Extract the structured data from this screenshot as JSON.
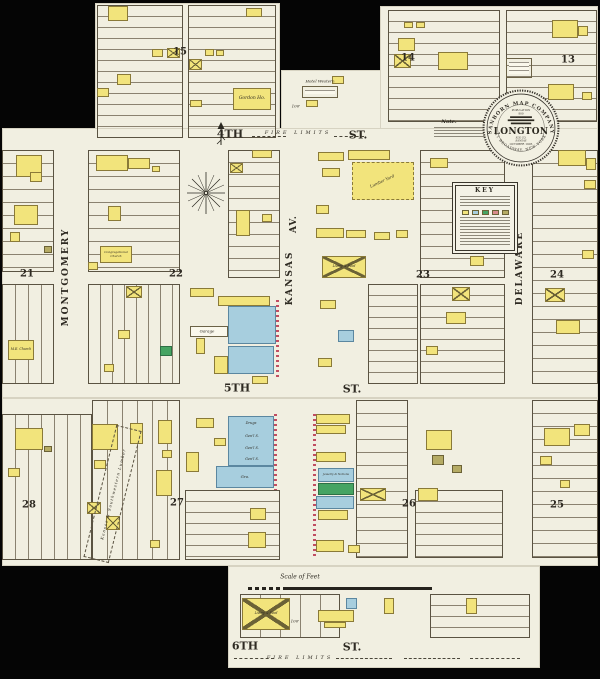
{
  "palette": {
    "paper": "#f1efe1",
    "background": "#050505",
    "ink": "#332f26",
    "lot_line": "#8a8270",
    "frame_yellow": "#f2e47c",
    "stone_blue": "#a7cede",
    "special_green": "#46a463",
    "adobe_olive": "#b5ab64",
    "brick_pink": "#d98b8b",
    "tick_red": "#c14e62"
  },
  "seal": {
    "arc_top": "SANBORN MAP COMPANY",
    "pop_label": "POPULATION",
    "pop_value": "800",
    "town": "LONGTON",
    "county1": "ELK CO.",
    "county2": "KANSAS",
    "date": "OCTOBER 1905",
    "arc_bottom": "11 BROADWAY. NEW YORK."
  },
  "key": {
    "title": "KEY"
  },
  "lumber": {
    "west_label": "Kansas & Southwestern Lumber"
  },
  "labels": [
    {
      "n": "street-4th",
      "t": "4TH",
      "x": 230,
      "y": 134,
      "s": 11,
      "b": 1
    },
    {
      "n": "street-4th-st",
      "t": "ST.",
      "x": 358,
      "y": 135,
      "s": 11,
      "b": 1
    },
    {
      "n": "fire-limits-top",
      "t": "FIRE LIMITS",
      "x": 298,
      "y": 133,
      "s": 5,
      "i": 1,
      "sp": 3
    },
    {
      "n": "street-5th",
      "t": "5TH",
      "x": 237,
      "y": 388,
      "s": 11,
      "b": 1
    },
    {
      "n": "street-5th-st",
      "t": "ST.",
      "x": 352,
      "y": 389,
      "s": 11,
      "b": 1
    },
    {
      "n": "street-6th",
      "t": "6TH",
      "x": 245,
      "y": 646,
      "s": 11,
      "b": 1
    },
    {
      "n": "street-6th-st",
      "t": "ST.",
      "x": 352,
      "y": 647,
      "s": 11,
      "b": 1
    },
    {
      "n": "fire-limits-bottom",
      "t": "FIRE LIMITS",
      "x": 300,
      "y": 658,
      "s": 5,
      "i": 1,
      "sp": 3
    },
    {
      "n": "street-kansas",
      "t": "KANSAS",
      "x": 290,
      "y": 278,
      "s": 9,
      "b": 1,
      "r": -90,
      "sp": 2
    },
    {
      "n": "street-kansas-av",
      "t": "AV.",
      "x": 294,
      "y": 224,
      "s": 9,
      "b": 1,
      "r": -90,
      "sp": 1
    },
    {
      "n": "street-montgomery",
      "t": "MONTGOMERY",
      "x": 66,
      "y": 277,
      "s": 9,
      "b": 1,
      "r": -90,
      "sp": 2
    },
    {
      "n": "street-delaware",
      "t": "DELAWARE",
      "x": 520,
      "y": 268,
      "s": 9,
      "b": 1,
      "r": -90,
      "sp": 2
    },
    {
      "n": "block-number-15",
      "t": "15",
      "x": 180,
      "y": 52,
      "s": 10,
      "b": 1
    },
    {
      "n": "block-number-14",
      "t": "14",
      "x": 408,
      "y": 58,
      "s": 10,
      "b": 1
    },
    {
      "n": "block-number-13",
      "t": "13",
      "x": 568,
      "y": 60,
      "s": 10,
      "b": 1
    },
    {
      "n": "block-number-21",
      "t": "21",
      "x": 27,
      "y": 274,
      "s": 10,
      "b": 1
    },
    {
      "n": "block-number-22",
      "t": "22",
      "x": 176,
      "y": 274,
      "s": 10,
      "b": 1
    },
    {
      "n": "block-number-23",
      "t": "23",
      "x": 423,
      "y": 275,
      "s": 10,
      "b": 1
    },
    {
      "n": "block-number-24",
      "t": "24",
      "x": 557,
      "y": 275,
      "s": 10,
      "b": 1
    },
    {
      "n": "block-number-28",
      "t": "28",
      "x": 29,
      "y": 505,
      "s": 10,
      "b": 1
    },
    {
      "n": "block-number-27",
      "t": "27",
      "x": 177,
      "y": 503,
      "s": 10,
      "b": 1
    },
    {
      "n": "block-number-26",
      "t": "26",
      "x": 409,
      "y": 504,
      "s": 10,
      "b": 1
    },
    {
      "n": "block-number-25",
      "t": "25",
      "x": 557,
      "y": 505,
      "s": 10,
      "b": 1
    },
    {
      "n": "scale-label",
      "t": "Scale of Feet",
      "x": 300,
      "y": 577,
      "s": 6,
      "i": 1
    },
    {
      "n": "note-title",
      "t": "Note.",
      "x": 449,
      "y": 122,
      "s": 5,
      "b": 1,
      "i": 1
    },
    {
      "n": "hotel-western-label",
      "t": "Hotel Western",
      "x": 320,
      "y": 81,
      "s": 4,
      "i": 1
    },
    {
      "n": "garage-label",
      "t": "Garage",
      "x": 207,
      "y": 331,
      "s": 4,
      "i": 1
    },
    {
      "n": "dimension-100-top",
      "t": "100'",
      "x": 296,
      "y": 106,
      "s": 4,
      "i": 1
    },
    {
      "n": "dimension-100-bottom",
      "t": "100'",
      "x": 295,
      "y": 621,
      "s": 4,
      "i": 1
    },
    {
      "n": "lumber-yard-east-label",
      "t": "Lumber Yard",
      "x": 382,
      "y": 181,
      "s": 4,
      "i": 1,
      "r": -25
    },
    {
      "n": "store-drugs-label",
      "t": "Drugs",
      "x": 251,
      "y": 423,
      "s": 3.5,
      "i": 1
    },
    {
      "n": "store-general-1-label",
      "t": "Gen'l S.",
      "x": 252,
      "y": 436,
      "s": 3.5,
      "i": 1
    },
    {
      "n": "store-general-2-label",
      "t": "Gen'l S.",
      "x": 252,
      "y": 448,
      "s": 3.5,
      "i": 1
    },
    {
      "n": "store-general-3-label",
      "t": "Gen'l S.",
      "x": 252,
      "y": 459,
      "s": 3.5,
      "i": 1
    }
  ],
  "lot_areas": [
    {
      "x": 97,
      "y": 5,
      "w": 86,
      "h": 133,
      "d": "h",
      "g": 11
    },
    {
      "x": 188,
      "y": 5,
      "w": 88,
      "h": 133,
      "d": "h",
      "g": 11
    },
    {
      "x": 388,
      "y": 10,
      "w": 112,
      "h": 112,
      "d": "h",
      "g": 11
    },
    {
      "x": 506,
      "y": 10,
      "w": 91,
      "h": 112,
      "d": "h",
      "g": 11
    },
    {
      "x": 2,
      "y": 150,
      "w": 52,
      "h": 122,
      "d": "h",
      "g": 13
    },
    {
      "x": 2,
      "y": 284,
      "w": 52,
      "h": 100,
      "d": "v",
      "g": 13
    },
    {
      "x": 88,
      "y": 150,
      "w": 92,
      "h": 122,
      "d": "h",
      "g": 13
    },
    {
      "x": 88,
      "y": 284,
      "w": 92,
      "h": 100,
      "d": "v",
      "g": 12
    },
    {
      "x": 228,
      "y": 150,
      "w": 52,
      "h": 128,
      "d": "h",
      "g": 12
    },
    {
      "x": 420,
      "y": 150,
      "w": 85,
      "h": 128,
      "d": "h",
      "g": 12
    },
    {
      "x": 420,
      "y": 284,
      "w": 85,
      "h": 100,
      "d": "h",
      "g": 11
    },
    {
      "x": 368,
      "y": 284,
      "w": 50,
      "h": 100,
      "d": "h",
      "g": 11
    },
    {
      "x": 532,
      "y": 150,
      "w": 66,
      "h": 234,
      "d": "h",
      "g": 13
    },
    {
      "x": 2,
      "y": 414,
      "w": 90,
      "h": 146,
      "d": "v",
      "g": 13
    },
    {
      "x": 92,
      "y": 400,
      "w": 88,
      "h": 160,
      "d": "v",
      "g": 15
    },
    {
      "x": 185,
      "y": 490,
      "w": 95,
      "h": 70,
      "d": "h",
      "g": 11
    },
    {
      "x": 356,
      "y": 400,
      "w": 52,
      "h": 158,
      "d": "h",
      "g": 13
    },
    {
      "x": 415,
      "y": 490,
      "w": 88,
      "h": 68,
      "d": "h",
      "g": 11
    },
    {
      "x": 532,
      "y": 400,
      "w": 66,
      "h": 158,
      "d": "h",
      "g": 13
    },
    {
      "x": 430,
      "y": 594,
      "w": 100,
      "h": 44,
      "d": "h",
      "g": 11
    },
    {
      "x": 240,
      "y": 594,
      "w": 100,
      "h": 44,
      "d": "v",
      "g": 20
    }
  ],
  "buildings": [
    {
      "x": 108,
      "y": 6,
      "w": 20,
      "h": 15,
      "c": "y"
    },
    {
      "x": 246,
      "y": 8,
      "w": 16,
      "h": 9,
      "c": "y"
    },
    {
      "x": 152,
      "y": 49,
      "w": 11,
      "h": 8,
      "c": "y"
    },
    {
      "x": 167,
      "y": 48,
      "w": 13,
      "h": 10,
      "c": "y",
      "xm": 1
    },
    {
      "x": 205,
      "y": 49,
      "w": 9,
      "h": 7,
      "c": "y"
    },
    {
      "x": 216,
      "y": 50,
      "w": 8,
      "h": 6,
      "c": "y"
    },
    {
      "x": 189,
      "y": 59,
      "w": 13,
      "h": 11,
      "c": "y",
      "xm": 1
    },
    {
      "x": 117,
      "y": 74,
      "w": 14,
      "h": 11,
      "c": "y"
    },
    {
      "x": 97,
      "y": 88,
      "w": 12,
      "h": 9,
      "c": "y"
    },
    {
      "x": 190,
      "y": 100,
      "w": 12,
      "h": 7,
      "c": "y"
    },
    {
      "x": 233,
      "y": 88,
      "w": 38,
      "h": 22,
      "c": "y",
      "l": "Gordon Ho.",
      "ls": 4.5,
      "n": "building-gordon-house"
    },
    {
      "x": 302,
      "y": 86,
      "w": 36,
      "h": 12,
      "c": "w",
      "ln": 1,
      "n": "building-hotel-western"
    },
    {
      "x": 306,
      "y": 100,
      "w": 12,
      "h": 7,
      "c": "y"
    },
    {
      "x": 332,
      "y": 76,
      "w": 12,
      "h": 8,
      "c": "y"
    },
    {
      "x": 404,
      "y": 22,
      "w": 9,
      "h": 6,
      "c": "y"
    },
    {
      "x": 416,
      "y": 22,
      "w": 9,
      "h": 6,
      "c": "y"
    },
    {
      "x": 398,
      "y": 38,
      "w": 17,
      "h": 13,
      "c": "y"
    },
    {
      "x": 394,
      "y": 54,
      "w": 17,
      "h": 14,
      "c": "y",
      "xm": 1
    },
    {
      "x": 438,
      "y": 52,
      "w": 30,
      "h": 18,
      "c": "y"
    },
    {
      "x": 506,
      "y": 58,
      "w": 26,
      "h": 20,
      "c": "w",
      "ln": 1
    },
    {
      "x": 552,
      "y": 20,
      "w": 26,
      "h": 18,
      "c": "y"
    },
    {
      "x": 578,
      "y": 26,
      "w": 10,
      "h": 10,
      "c": "y"
    },
    {
      "x": 548,
      "y": 84,
      "w": 26,
      "h": 16,
      "c": "y"
    },
    {
      "x": 582,
      "y": 92,
      "w": 10,
      "h": 8,
      "c": "y"
    },
    {
      "x": 16,
      "y": 155,
      "w": 26,
      "h": 22,
      "c": "y"
    },
    {
      "x": 30,
      "y": 172,
      "w": 12,
      "h": 10,
      "c": "y"
    },
    {
      "x": 14,
      "y": 205,
      "w": 24,
      "h": 20,
      "c": "y"
    },
    {
      "x": 10,
      "y": 232,
      "w": 10,
      "h": 10,
      "c": "y"
    },
    {
      "x": 8,
      "y": 340,
      "w": 26,
      "h": 20,
      "c": "y",
      "l": "M.E. Church",
      "ls": 3.2,
      "n": "building-me-church"
    },
    {
      "x": 44,
      "y": 246,
      "w": 8,
      "h": 7,
      "c": "o"
    },
    {
      "x": 96,
      "y": 155,
      "w": 32,
      "h": 16,
      "c": "y"
    },
    {
      "x": 128,
      "y": 158,
      "w": 22,
      "h": 11,
      "c": "y"
    },
    {
      "x": 152,
      "y": 166,
      "w": 8,
      "h": 6,
      "c": "y"
    },
    {
      "x": 108,
      "y": 206,
      "w": 13,
      "h": 15,
      "c": "y"
    },
    {
      "x": 100,
      "y": 246,
      "w": 32,
      "h": 17,
      "c": "y",
      "l": "Congregational Church",
      "ls": 3,
      "n": "building-congregational-church"
    },
    {
      "x": 88,
      "y": 262,
      "w": 10,
      "h": 8,
      "c": "y"
    },
    {
      "x": 126,
      "y": 286,
      "w": 16,
      "h": 12,
      "c": "y",
      "xm": 1
    },
    {
      "x": 118,
      "y": 330,
      "w": 12,
      "h": 9,
      "c": "y"
    },
    {
      "x": 160,
      "y": 346,
      "w": 12,
      "h": 10,
      "c": "g"
    },
    {
      "x": 104,
      "y": 364,
      "w": 10,
      "h": 8,
      "c": "y"
    },
    {
      "x": 252,
      "y": 150,
      "w": 20,
      "h": 8,
      "c": "y"
    },
    {
      "x": 230,
      "y": 163,
      "w": 13,
      "h": 10,
      "c": "y",
      "xm": 1
    },
    {
      "x": 236,
      "y": 210,
      "w": 14,
      "h": 26,
      "c": "y"
    },
    {
      "x": 262,
      "y": 214,
      "w": 10,
      "h": 8,
      "c": "y"
    },
    {
      "x": 190,
      "y": 288,
      "w": 24,
      "h": 9,
      "c": "y"
    },
    {
      "x": 218,
      "y": 296,
      "w": 52,
      "h": 10,
      "c": "y"
    },
    {
      "x": 190,
      "y": 326,
      "w": 38,
      "h": 11,
      "c": "w"
    },
    {
      "x": 196,
      "y": 338,
      "w": 9,
      "h": 16,
      "c": "y"
    },
    {
      "x": 228,
      "y": 306,
      "w": 48,
      "h": 38,
      "c": "b"
    },
    {
      "x": 228,
      "y": 346,
      "w": 46,
      "h": 28,
      "c": "b"
    },
    {
      "x": 214,
      "y": 356,
      "w": 14,
      "h": 18,
      "c": "y"
    },
    {
      "x": 252,
      "y": 376,
      "w": 16,
      "h": 8,
      "c": "y"
    },
    {
      "x": 318,
      "y": 152,
      "w": 26,
      "h": 9,
      "c": "y"
    },
    {
      "x": 348,
      "y": 150,
      "w": 42,
      "h": 10,
      "c": "y"
    },
    {
      "x": 322,
      "y": 168,
      "w": 18,
      "h": 9,
      "c": "y"
    },
    {
      "x": 352,
      "y": 162,
      "w": 62,
      "h": 38,
      "c": "y",
      "ds": 1,
      "n": "building-lumber-shed"
    },
    {
      "x": 316,
      "y": 205,
      "w": 13,
      "h": 9,
      "c": "y"
    },
    {
      "x": 316,
      "y": 228,
      "w": 28,
      "h": 10,
      "c": "y"
    },
    {
      "x": 346,
      "y": 230,
      "w": 20,
      "h": 8,
      "c": "y"
    },
    {
      "x": 374,
      "y": 232,
      "w": 16,
      "h": 8,
      "c": "y"
    },
    {
      "x": 396,
      "y": 230,
      "w": 12,
      "h": 8,
      "c": "y"
    },
    {
      "x": 322,
      "y": 256,
      "w": 44,
      "h": 22,
      "c": "y",
      "xm": 1,
      "l": "Livery & Feed",
      "ls": 3.2,
      "n": "building-livery-feed"
    },
    {
      "x": 320,
      "y": 300,
      "w": 16,
      "h": 9,
      "c": "y"
    },
    {
      "x": 338,
      "y": 330,
      "w": 16,
      "h": 12,
      "c": "b"
    },
    {
      "x": 318,
      "y": 358,
      "w": 14,
      "h": 9,
      "c": "y"
    },
    {
      "x": 430,
      "y": 158,
      "w": 18,
      "h": 10,
      "c": "y"
    },
    {
      "x": 470,
      "y": 256,
      "w": 14,
      "h": 10,
      "c": "y"
    },
    {
      "x": 452,
      "y": 287,
      "w": 18,
      "h": 14,
      "c": "y",
      "xm": 1
    },
    {
      "x": 446,
      "y": 312,
      "w": 20,
      "h": 12,
      "c": "y"
    },
    {
      "x": 426,
      "y": 346,
      "w": 12,
      "h": 9,
      "c": "y"
    },
    {
      "x": 558,
      "y": 150,
      "w": 28,
      "h": 16,
      "c": "y"
    },
    {
      "x": 586,
      "y": 158,
      "w": 10,
      "h": 12,
      "c": "y"
    },
    {
      "x": 584,
      "y": 180,
      "w": 12,
      "h": 9,
      "c": "y"
    },
    {
      "x": 582,
      "y": 250,
      "w": 12,
      "h": 9,
      "c": "y"
    },
    {
      "x": 545,
      "y": 288,
      "w": 20,
      "h": 14,
      "c": "y",
      "xm": 1
    },
    {
      "x": 556,
      "y": 320,
      "w": 24,
      "h": 14,
      "c": "y"
    },
    {
      "x": 15,
      "y": 428,
      "w": 28,
      "h": 22,
      "c": "y"
    },
    {
      "x": 8,
      "y": 468,
      "w": 12,
      "h": 9,
      "c": "y"
    },
    {
      "x": 44,
      "y": 446,
      "w": 8,
      "h": 6,
      "c": "o"
    },
    {
      "x": 87,
      "y": 502,
      "w": 14,
      "h": 12,
      "c": "y",
      "xm": 1
    },
    {
      "x": 106,
      "y": 516,
      "w": 14,
      "h": 14,
      "c": "y",
      "xm": 1
    },
    {
      "x": 92,
      "y": 424,
      "w": 26,
      "h": 26,
      "c": "y"
    },
    {
      "x": 94,
      "y": 460,
      "w": 12,
      "h": 9,
      "c": "y"
    },
    {
      "x": 130,
      "y": 423,
      "w": 13,
      "h": 21,
      "c": "y"
    },
    {
      "x": 158,
      "y": 420,
      "w": 14,
      "h": 24,
      "c": "y"
    },
    {
      "x": 162,
      "y": 450,
      "w": 10,
      "h": 8,
      "c": "y"
    },
    {
      "x": 156,
      "y": 470,
      "w": 16,
      "h": 26,
      "c": "y"
    },
    {
      "x": 150,
      "y": 540,
      "w": 10,
      "h": 8,
      "c": "y"
    },
    {
      "x": 196,
      "y": 418,
      "w": 18,
      "h": 10,
      "c": "y"
    },
    {
      "x": 214,
      "y": 438,
      "w": 12,
      "h": 8,
      "c": "y"
    },
    {
      "x": 186,
      "y": 452,
      "w": 13,
      "h": 20,
      "c": "y"
    },
    {
      "x": 228,
      "y": 416,
      "w": 46,
      "h": 50,
      "c": "b",
      "n": "building-store-row"
    },
    {
      "x": 216,
      "y": 466,
      "w": 58,
      "h": 22,
      "c": "b",
      "l": "Gro.",
      "ls": 4,
      "n": "building-grocery"
    },
    {
      "x": 250,
      "y": 508,
      "w": 16,
      "h": 12,
      "c": "y"
    },
    {
      "x": 248,
      "y": 532,
      "w": 18,
      "h": 16,
      "c": "y"
    },
    {
      "x": 316,
      "y": 414,
      "w": 34,
      "h": 10,
      "c": "y"
    },
    {
      "x": 316,
      "y": 425,
      "w": 30,
      "h": 9,
      "c": "y"
    },
    {
      "x": 316,
      "y": 452,
      "w": 30,
      "h": 10,
      "c": "y"
    },
    {
      "x": 318,
      "y": 468,
      "w": 36,
      "h": 14,
      "c": "b",
      "l": "Jewelry & Notions",
      "ls": 2.8,
      "n": "building-jewelry"
    },
    {
      "x": 318,
      "y": 483,
      "w": 36,
      "h": 12,
      "c": "g"
    },
    {
      "x": 316,
      "y": 496,
      "w": 38,
      "h": 13,
      "c": "b"
    },
    {
      "x": 318,
      "y": 510,
      "w": 30,
      "h": 10,
      "c": "y"
    },
    {
      "x": 316,
      "y": 540,
      "w": 28,
      "h": 12,
      "c": "y"
    },
    {
      "x": 348,
      "y": 545,
      "w": 12,
      "h": 8,
      "c": "y"
    },
    {
      "x": 360,
      "y": 488,
      "w": 26,
      "h": 13,
      "c": "y",
      "xm": 1
    },
    {
      "x": 426,
      "y": 430,
      "w": 26,
      "h": 20,
      "c": "y"
    },
    {
      "x": 432,
      "y": 455,
      "w": 12,
      "h": 10,
      "c": "o"
    },
    {
      "x": 452,
      "y": 465,
      "w": 10,
      "h": 8,
      "c": "o"
    },
    {
      "x": 418,
      "y": 488,
      "w": 20,
      "h": 13,
      "c": "y"
    },
    {
      "x": 544,
      "y": 428,
      "w": 26,
      "h": 18,
      "c": "y"
    },
    {
      "x": 574,
      "y": 424,
      "w": 16,
      "h": 12,
      "c": "y"
    },
    {
      "x": 540,
      "y": 456,
      "w": 12,
      "h": 9,
      "c": "y"
    },
    {
      "x": 560,
      "y": 480,
      "w": 10,
      "h": 8,
      "c": "y"
    },
    {
      "x": 242,
      "y": 598,
      "w": 48,
      "h": 32,
      "c": "y",
      "xm": 1,
      "l": "Livery & Feed",
      "ls": 3.2,
      "n": "building-livery-feed-south"
    },
    {
      "x": 318,
      "y": 610,
      "w": 36,
      "h": 12,
      "c": "y"
    },
    {
      "x": 324,
      "y": 622,
      "w": 22,
      "h": 6,
      "c": "y"
    },
    {
      "x": 346,
      "y": 598,
      "w": 11,
      "h": 11,
      "c": "b"
    },
    {
      "x": 384,
      "y": 598,
      "w": 10,
      "h": 16,
      "c": "y"
    },
    {
      "x": 466,
      "y": 598,
      "w": 11,
      "h": 16,
      "c": "y"
    }
  ],
  "dash_lines": [
    {
      "x": 252,
      "y": 136,
      "w": 34
    },
    {
      "x": 334,
      "y": 136,
      "w": 30
    },
    {
      "x": 234,
      "y": 658,
      "w": 40
    },
    {
      "x": 336,
      "y": 658,
      "w": 56
    },
    {
      "x": 404,
      "y": 658,
      "w": 56
    },
    {
      "x": 470,
      "y": 658,
      "w": 50
    }
  ],
  "edge_ticks": [
    {
      "x": 276,
      "y": 300,
      "h": 78
    },
    {
      "x": 274,
      "y": 414,
      "h": 76
    },
    {
      "x": 313,
      "y": 414,
      "h": 142
    }
  ]
}
